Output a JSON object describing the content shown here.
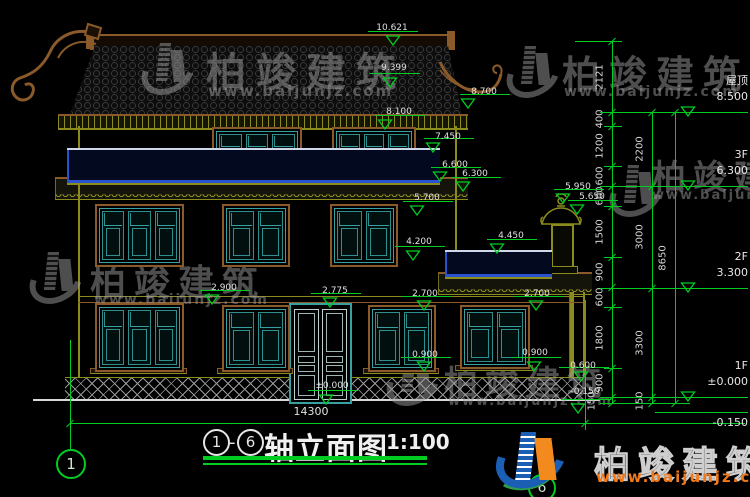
{
  "title": {
    "axis_start": "1",
    "dash": "-",
    "axis_end": "6",
    "name": "轴立面图",
    "scale": "1:100"
  },
  "total_dim": "14300",
  "axis_bubbles": {
    "left": "1",
    "bottom": "6"
  },
  "floors": [
    {
      "name": "屋顶",
      "value": "8.500"
    },
    {
      "name": "3F",
      "value": "6.300"
    },
    {
      "name": "2F",
      "value": "3.300"
    },
    {
      "name": "1F",
      "value": "±0.000"
    },
    {
      "name": "",
      "value": "-0.150"
    }
  ],
  "levels": [
    "10.621",
    "9.399",
    "8.700",
    "8.100",
    "7.450",
    "6.600",
    "6.300",
    "5.700",
    "5.950",
    "5.650",
    "4.450",
    "4.200",
    "2.900",
    "2.775",
    "2.700",
    "2.700",
    "0.900",
    "0.900",
    "0.600",
    "±0.000",
    "-0.150"
  ],
  "dim_chains": {
    "inner": [
      "2121",
      "400",
      "1200",
      "600",
      "600",
      "1500",
      "900",
      "600",
      "1800",
      "900",
      "150"
    ],
    "middle": [
      "2200",
      "3000",
      "3300",
      "150"
    ],
    "outer": [
      "8650"
    ]
  },
  "watermark": {
    "name": "柏竣建筑",
    "url": "www.baijunjz.com"
  },
  "colors": {
    "dim_green": "#00cc22",
    "window_teal": "#2e9e9e",
    "railing_blue": "#2a52cc",
    "trim_brown": "#8a5a2b",
    "wall_olive": "#8c8c1e",
    "logo_blue": "#1a5fb4",
    "logo_orange": "#f28a1e",
    "url_orange": "#f07818"
  }
}
